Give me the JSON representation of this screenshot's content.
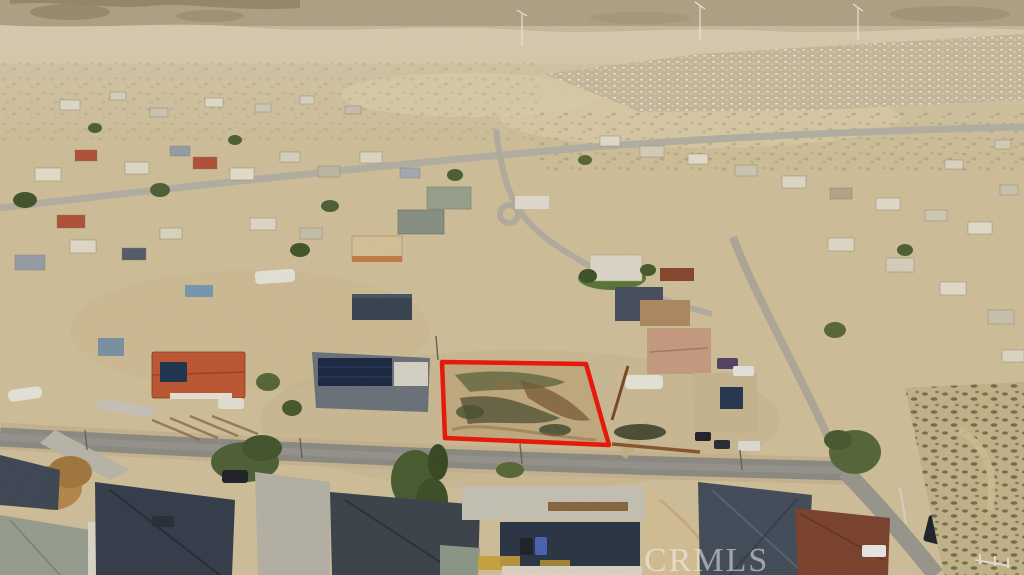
{
  "photo": {
    "kind": "aerial-drone-photo",
    "watermark": {
      "text": "CRMLS"
    },
    "annotation": {
      "lot_outline_color": "#ee1a0e",
      "label": "subject-vacant-lot-outline"
    },
    "palette": {
      "desert_sand": "#d2c29c",
      "distant_haze": "#ddd2b6",
      "hills": "#b3a68a",
      "asphalt_street": "#8f8d86",
      "dirt_road": "#b6b0a2",
      "red_tile_roof": "#c05a36",
      "dark_shingle_roof": "#39414e",
      "slate_roof": "#46505c",
      "brown_roof": "#7e4631",
      "solar_panel": "#1f2c45",
      "tree_green": "#52633a",
      "scrub_olive": "#6a6f45",
      "concrete": "#c8c4b6"
    }
  }
}
